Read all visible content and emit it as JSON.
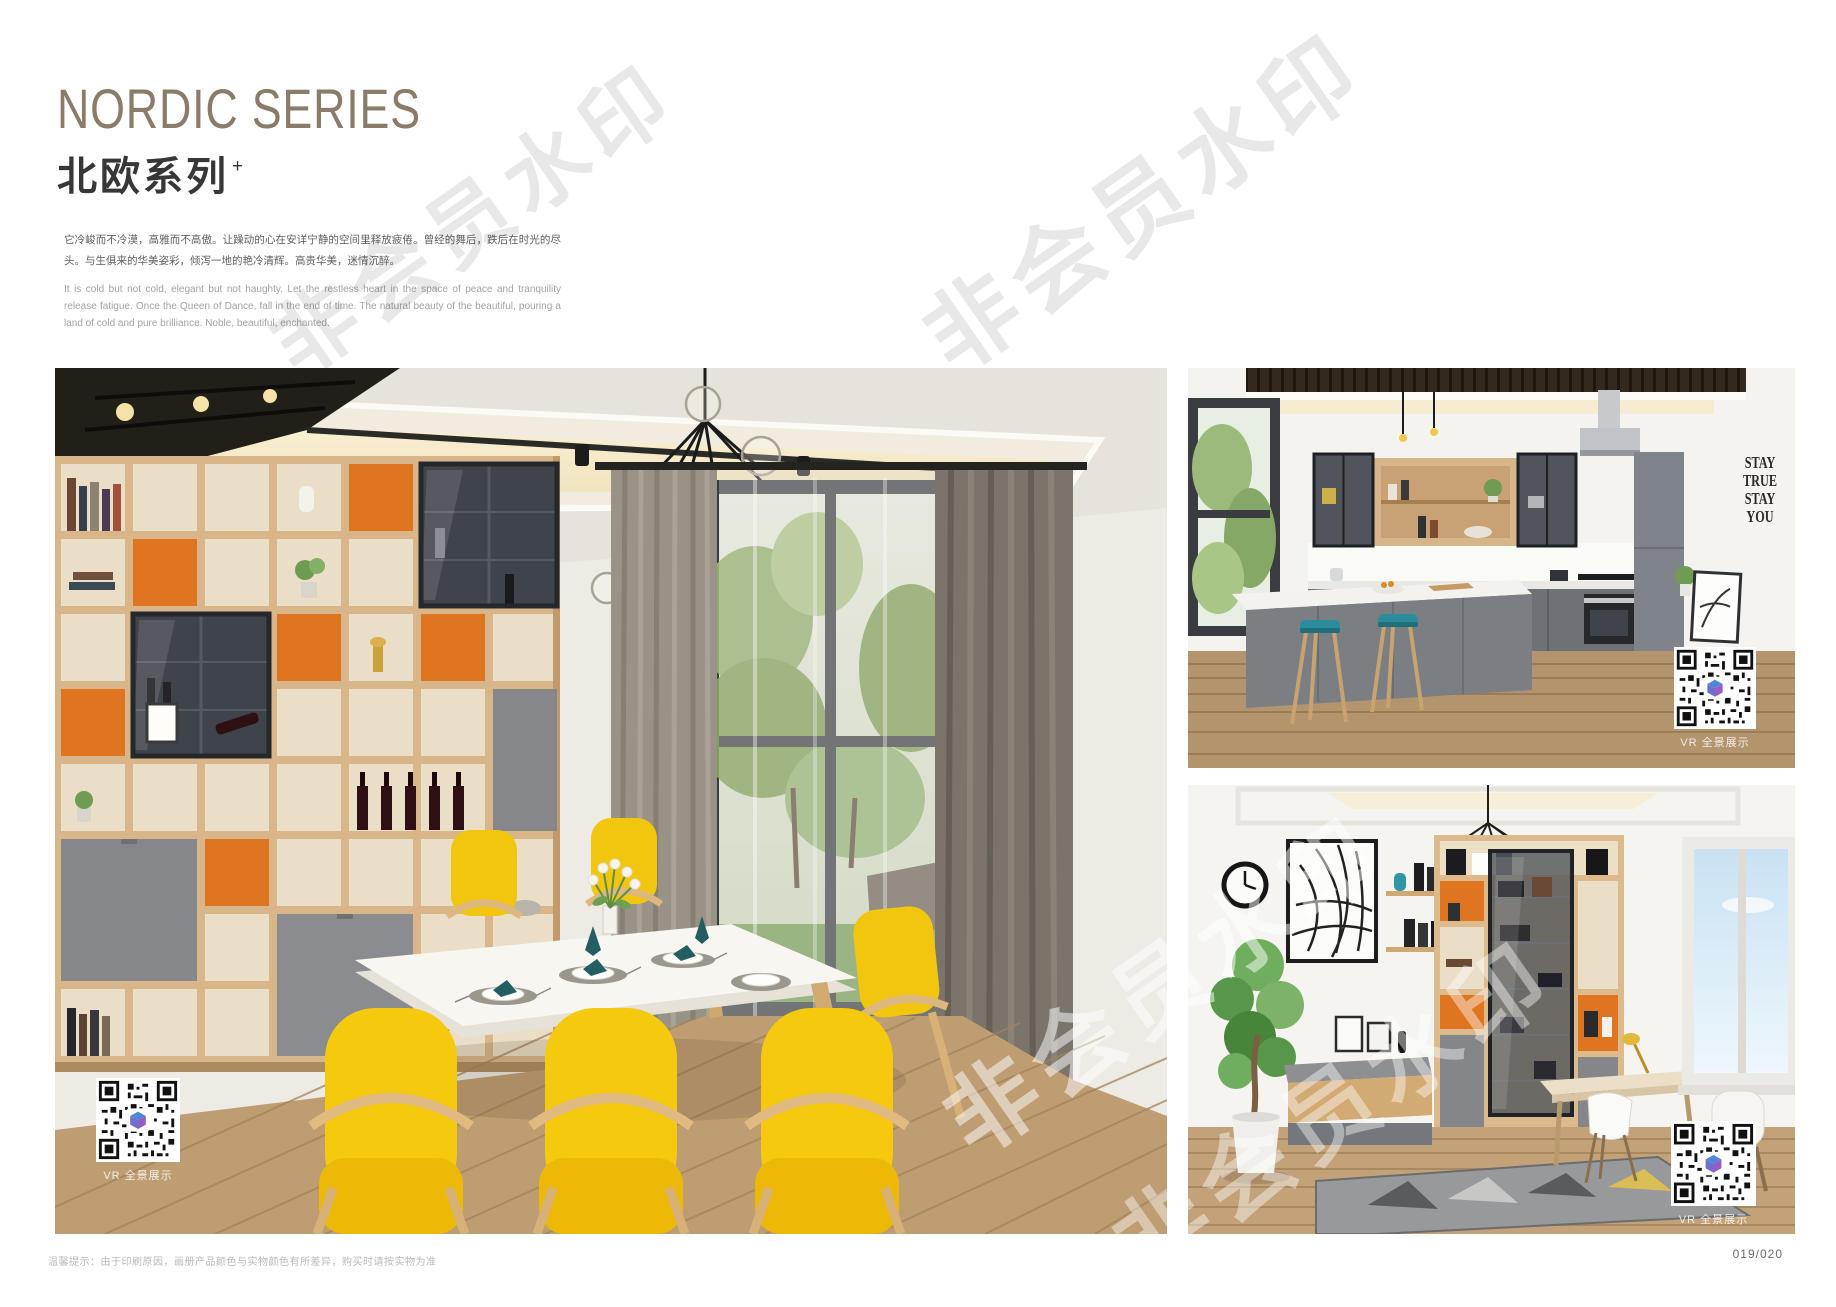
{
  "header": {
    "title_en": "NORDIC SERIES",
    "title_zh": "北欧系列",
    "title_plus": "+",
    "desc_zh": "它冷峻而不冷漠，高雅而不高傲。让躁动的心在安详宁静的空间里释放疲倦。曾经的舞后，跌后在时光的尽头。与生俱来的华美姿彩，倾泻一地的艳冷清辉。高贵华美，迷情沉醉。",
    "desc_en": "It is cold but not cold, elegant but not haughty. Let the restless heart in the space of peace and tranquility release fatigue. Once the Queen of Dance, fall in the end of time. The natural beauty of the beautiful, pouring a land of cold and pure brilliance. Noble, beautiful, enchanted."
  },
  "photos": {
    "vr_label": "VR 全景展示",
    "kitchen_wall_decal": [
      "STAY",
      "TRUE",
      "STAY",
      "YOU"
    ]
  },
  "watermark_text": "非会员水印",
  "footer": {
    "note": "温馨提示：由于印刷原因，画册产品颜色与实物颜色有所差异，购买时请按实物为准",
    "page_number": "019/020"
  },
  "colors": {
    "title_taupe": "#8b7c69",
    "shelf_orange": "#df7520",
    "chair_yellow": "#f4c90e",
    "stool_teal": "#2b8d9b",
    "napkin_teal": "#235e62",
    "qr_logo_blue": "#4e86d8",
    "qr_logo_purple": "#9a5ac8"
  }
}
